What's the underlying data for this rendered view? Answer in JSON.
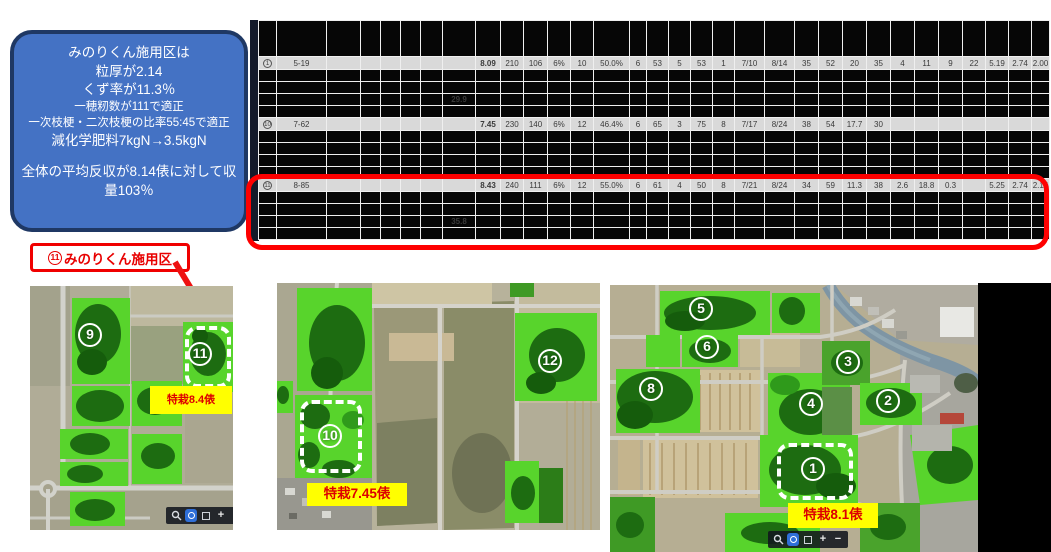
{
  "callout": {
    "lines": [
      "みのりくん施用区は",
      "粒厚が2.14",
      "くず率が11.3％",
      "一穂籾数が111で適正",
      "一次枝梗・二次枝梗の比率55:45で適正",
      "減化学肥料7kgN→3.5kgN",
      "",
      "全体の平均反収が8.14俵に対して収量103％"
    ]
  },
  "annotation": {
    "num": "⑪",
    "num_digit": "11",
    "label": "みのりくん施用区"
  },
  "table": {
    "groups": [
      {
        "num": "①",
        "num_digit": "1",
        "id": "5-19",
        "values": [
          "8.09",
          "210",
          "106",
          "6%",
          "10",
          "50.0%",
          "6",
          "53",
          "5",
          "53",
          "1",
          "7/10",
          "8/14",
          "35",
          "52",
          "20",
          "35",
          "4",
          "11",
          "9",
          "22",
          "5.19",
          "2.74",
          "2.00"
        ],
        "red_indices": [
          0,
          2,
          13,
          15,
          19,
          23
        ],
        "sub_value": "29.9"
      },
      {
        "num": "⑩",
        "num_digit": "10",
        "id": "7-62",
        "values": [
          "7.45",
          "230",
          "140",
          "6%",
          "12",
          "46.4%",
          "6",
          "65",
          "3",
          "75",
          "8",
          "7/17",
          "8/24",
          "38",
          "54",
          "17.7",
          "30",
          "",
          "",
          "",
          "",
          "",
          "",
          ""
        ],
        "red_indices": [],
        "sub_value": ""
      },
      {
        "num": "⑪",
        "num_digit": "11",
        "id": "8-85",
        "values": [
          "8.43",
          "240",
          "111",
          "6%",
          "12",
          "55.0%",
          "6",
          "61",
          "4",
          "50",
          "8",
          "7/21",
          "8/24",
          "34",
          "59",
          "11.3",
          "38",
          "2.6",
          "18.8",
          "0.3",
          "",
          "5.25",
          "2.74",
          "2.14"
        ],
        "red_indices": [
          0,
          2,
          13,
          15,
          19,
          23
        ],
        "sub_value": "35.8"
      }
    ]
  },
  "maps": [
    {
      "name": "left",
      "yield_label": "特栽8.4俵",
      "markers": [
        {
          "num": "9"
        },
        {
          "num": "11"
        }
      ]
    },
    {
      "name": "middle",
      "yield_label": "特栽7.45俵",
      "markers": [
        {
          "num": "10"
        },
        {
          "num": "12"
        }
      ]
    },
    {
      "name": "right",
      "yield_label": "特栽8.1俵",
      "markers": [
        {
          "num": "5"
        },
        {
          "num": "6"
        },
        {
          "num": "8"
        },
        {
          "num": "3"
        },
        {
          "num": "4"
        },
        {
          "num": "2"
        },
        {
          "num": "1"
        }
      ]
    }
  ],
  "map_toolbar": {
    "plus": "+",
    "minus": "−"
  },
  "colors": {
    "callout_bg": "#4472c4",
    "callout_border": "#1f3864",
    "highlight_red": "#fe0000",
    "value_red": "#ff5a5a",
    "row_gray": "#d9d9d9",
    "label_yellow": "#ffff00",
    "label_text_red": "#dd0000",
    "field_green": "#58d42c",
    "field_dark_green": "#1d6c11",
    "toolbar_blue": "#2f6fd8"
  }
}
